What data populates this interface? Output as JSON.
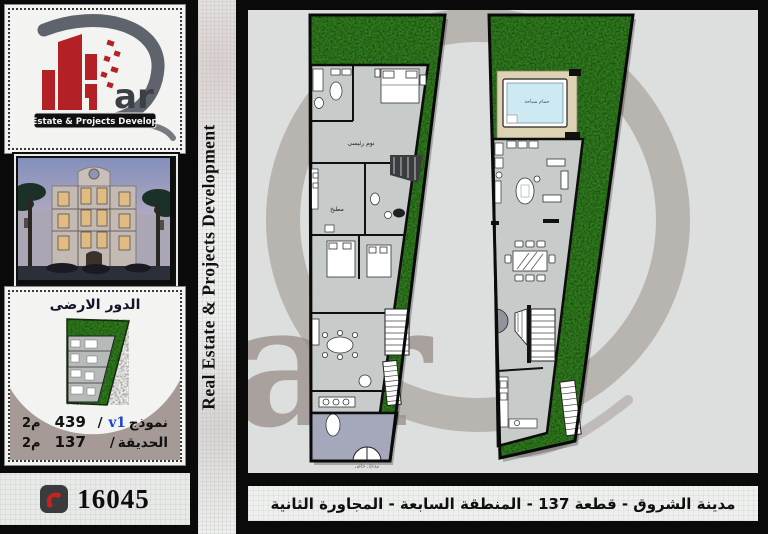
{
  "brand": {
    "logo_text": "ar",
    "banner": "Real Estate & Projects Development"
  },
  "vertical_banner": "Real Estate & Projects Development",
  "watermark_text": "ar",
  "sidebar": {
    "site_panel": {
      "title": "الدور الارضى",
      "model_row": {
        "label": "نموذج",
        "model": "v1",
        "slash": "/",
        "area": "439",
        "unit": "م2"
      },
      "garden_row": {
        "label": "الحديقة",
        "slash": "/",
        "area": "137",
        "unit": "م2"
      }
    },
    "phone": "16045"
  },
  "plans": {
    "left": {
      "master_bedroom": "نوم رئيسى",
      "kitchen": "مطبخ",
      "entrance": "مدخل خاص"
    },
    "right": {
      "pool": "حمام سباحة"
    }
  },
  "footer": {
    "caption": "مدينة الشروق - قطعة 137 - المنطقة السابعة - المجاورة الثانية"
  },
  "colors": {
    "grass": "#2f7d1d",
    "accent_red": "#b32025",
    "model_blue": "#1b3fd4",
    "mauve": "#a69a96",
    "floor_gray": "#c7cbc9",
    "entrance_gray": "#a5a8ba",
    "pool_blue": "#cde9f2"
  }
}
